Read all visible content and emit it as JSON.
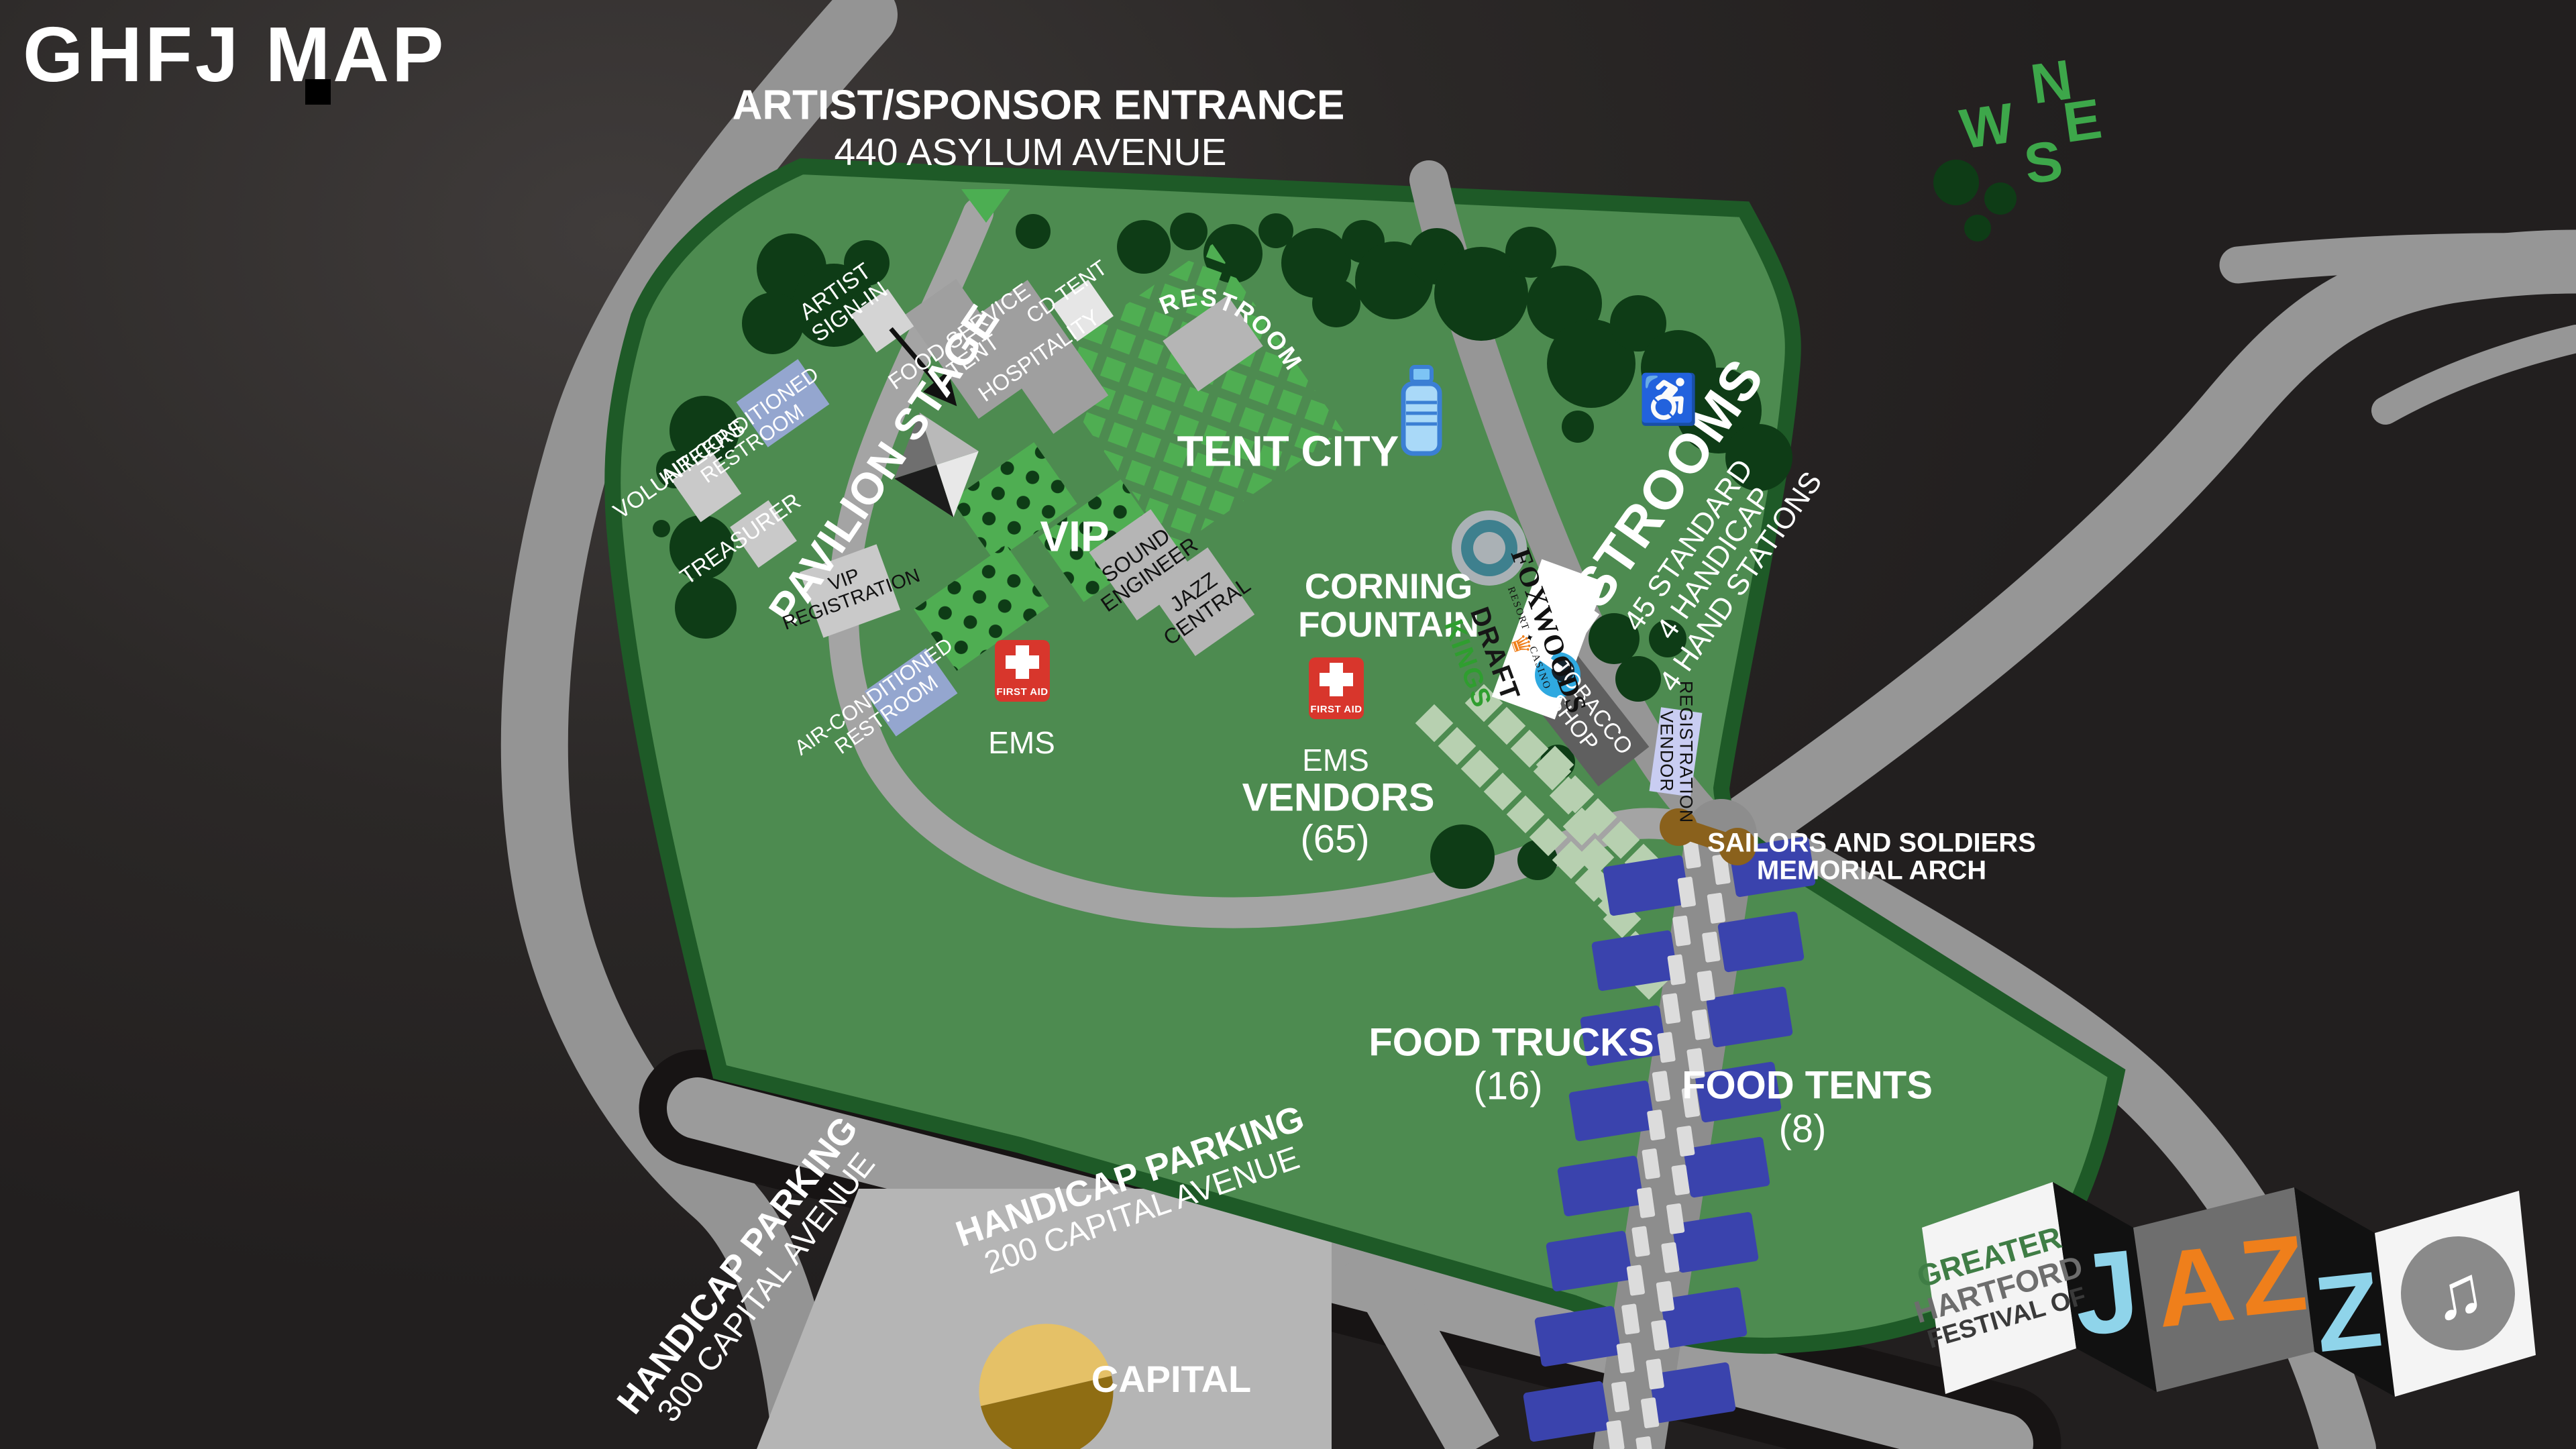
{
  "title": "GHFJ MAP",
  "entrance": {
    "line1": "ARTIST/SPONSOR ENTRANCE",
    "line2": "440 ASYLUM AVENUE"
  },
  "compass": {
    "n": "N",
    "w": "W",
    "e": "E",
    "s": "S"
  },
  "stage": {
    "label": "PAVILION STAGE"
  },
  "areas": {
    "tent_city": "TENT CITY",
    "vip": "VIP",
    "vendors": "VENDORS",
    "vendors_count": "(65)",
    "food_trucks": "FOOD TRUCKS",
    "food_trucks_count": "(16)",
    "food_tents": "FOOD TENTS",
    "food_tents_count": "(8)",
    "corning": [
      "CORNING",
      "FOUNTAIN"
    ],
    "capital": "CAPITAL"
  },
  "labels": {
    "artist_sign_in": [
      "ARTIST",
      "SIGN-IN"
    ],
    "food_service_tent": [
      "FOOD SERVICE",
      "TENT"
    ],
    "hospitality": [
      "HOSPITALITY"
    ],
    "cd_tent": [
      "CD TENT"
    ],
    "restrooms_top": "RESTROOMS",
    "volunteers": [
      "VOLUNTEERS"
    ],
    "treasurer": [
      "TREASURER"
    ],
    "ac_restroom": [
      "AIR-CONDITIONED",
      "RESTROOM"
    ],
    "vip_registration": [
      "VIP",
      "REGISTRATION"
    ],
    "sound_engineer": [
      "SOUND",
      "ENGINEER"
    ],
    "jazz_central": [
      "JAZZ",
      "CENTRAL"
    ],
    "tobacco_shop": [
      "TOBACCO",
      "SHOP"
    ],
    "vendor_registration": [
      "VENDOR",
      "REGISTRATION"
    ]
  },
  "restrooms_right": {
    "title": "RESTROOMS",
    "lines": [
      "45 STANDARD",
      "4 HANDICAP",
      "4 HAND STATIONS"
    ]
  },
  "ems": {
    "first_aid": "FIRST AID",
    "label": "EMS"
  },
  "memorial": {
    "line1": "SAILORS AND SOLDIERS",
    "line2": "MEMORIAL ARCH"
  },
  "parking": {
    "p300": [
      "HANDICAP PARKING",
      "300 CAPITAL AVENUE"
    ],
    "p200": [
      "HANDICAP PARKING",
      "200 CAPITAL AVENUE"
    ]
  },
  "sponsors": {
    "crown": "♛",
    "draft": "DRAFT",
    "kings": "KINGS",
    "foxwoods": "FOXWOODS",
    "foxwoods_sub": "RESORT ✦ CASINO"
  },
  "logo": {
    "words": [
      "GREATER",
      "HARTFORD",
      "FESTIVAL OF"
    ],
    "letters": [
      "J",
      "A",
      "Z",
      "Z"
    ],
    "note": "♫"
  },
  "icons": {
    "wheelchair": "♿"
  },
  "colors": {
    "park_green": "#4d8b50",
    "border_green": "#1e5a27",
    "road_gray": "#969696",
    "tree_green": "#0e3c16",
    "booth_green": "#4fae52",
    "vendor_diamond": "#b7d0b0",
    "truck_blue": "#3a43ad",
    "ems_red": "#d8362c",
    "compass_green": "#3da74a",
    "arch_brown": "#8a611c",
    "dome_gold": "#e5c167",
    "fountain_teal": "#3e808e",
    "logo_blue": "#8fd4ea",
    "logo_orange": "#ef7f1b"
  }
}
